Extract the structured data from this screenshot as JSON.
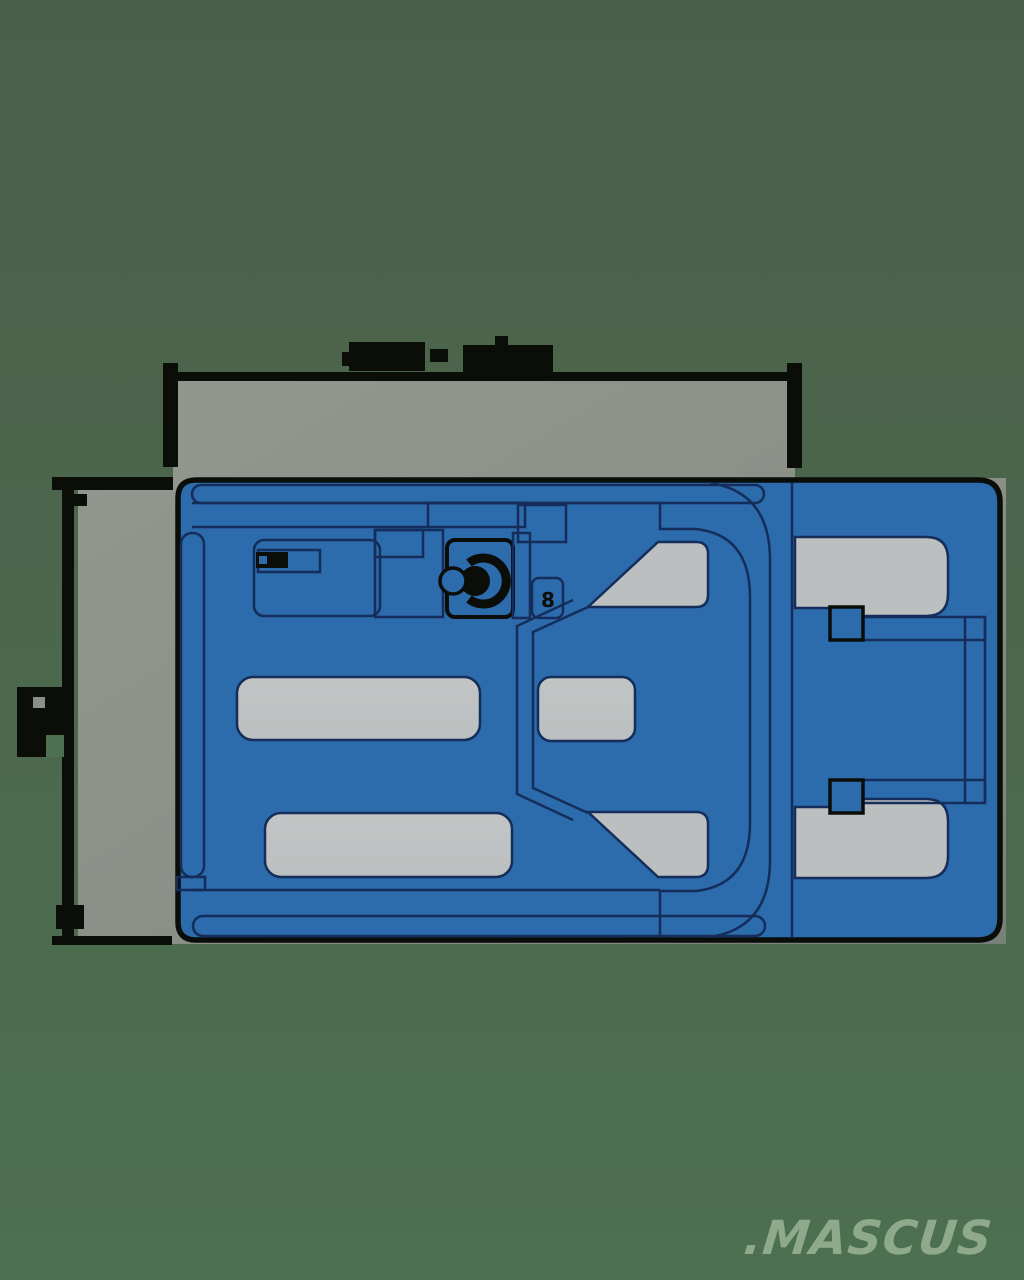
{
  "watermark": {
    "text": ".MASCUS"
  },
  "drawing": {
    "subject": "warehouse-truck-top-view",
    "view": "top",
    "component_marking": "8",
    "dimension_annotations": [
      {
        "id": "overall-length",
        "orientation": "horizontal",
        "location": "top",
        "label_text_legible": false
      },
      {
        "id": "overall-width",
        "orientation": "vertical",
        "location": "left",
        "label_text_legible": false
      }
    ]
  },
  "colors": {
    "background-top": "#4a5f48",
    "background-bottom": "#4d7051",
    "plate": "#8b8f88",
    "plate-light": "#94978f",
    "plate-dark": "#78817a",
    "machine-blue": "#2c6bac",
    "outline-navy": "#152d5a",
    "outline-black": "#0a0d08",
    "cutout-gray": "#bcbfbf",
    "watermark-green": "#8fa98b"
  }
}
